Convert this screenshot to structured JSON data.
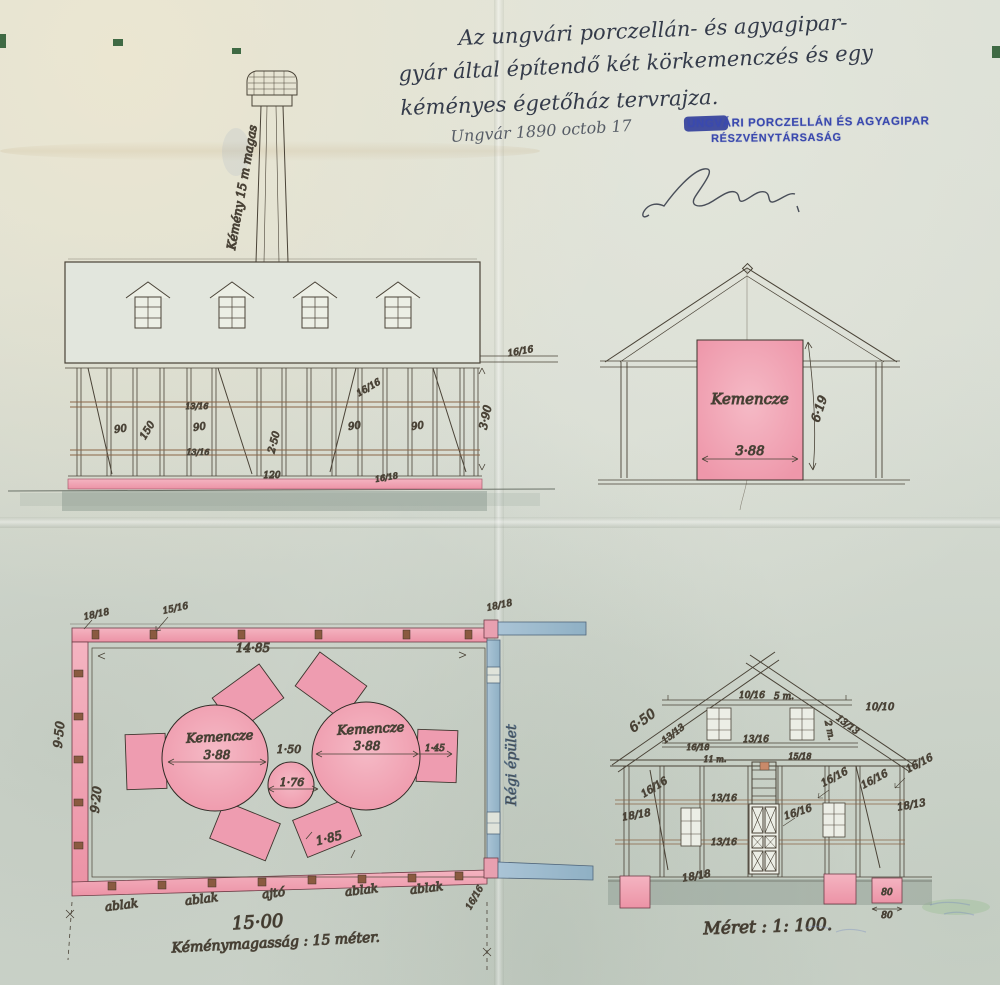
{
  "header": {
    "title_line1": "Az ungvári porczellán- és agyagipar-",
    "title_line2": "gyár által építendő két körkemenczés és egy",
    "title_line3": "kéményes égetőház tervrajza.",
    "date": "Ungvár 1890 octob 17",
    "stamp": {
      "line1": "UNGVÁRI PORCZELLÁN ÉS AGYAGIPAR",
      "line2": "RÉSZVÉNYTÁRSASÁG"
    }
  },
  "front_elevation": {
    "chimney_label": "Kémény 15 m magas",
    "dims": {
      "bay1": "90",
      "mid_height": "150",
      "bay2": "90",
      "timber_upper": "13/16",
      "timber_lower": "13/16",
      "wall_height": "2·50",
      "door_width": "120",
      "bay3": "90",
      "bay4": "90",
      "beam_inner": "16/16",
      "beam_right": "16/16",
      "right_height": "3·90",
      "sill": "16/18"
    }
  },
  "cross_section": {
    "kiln_label": "Kemencze",
    "kiln_width": "3·88",
    "kiln_height": "6·19"
  },
  "floor_plan": {
    "kiln1_label": "Kemencze",
    "kiln2_label": "Kemencze",
    "dims": {
      "inner_width": "14·85",
      "outer_depth": "9·50",
      "inner_depth": "9·20",
      "kiln1_diameter": "3·88",
      "kiln2_diameter": "3·88",
      "kiln_gap": "1·50",
      "flue_diameter": "1·76",
      "side_clearance": "1·45",
      "chamber_width": "1·85",
      "total_width": "15·00",
      "corner_tl": "18/18",
      "top_post": "15/16",
      "corner_tr": "18/18",
      "corner_br": "16/16"
    },
    "openings": [
      "ablak",
      "ablak",
      "ajtó",
      "ablak",
      "ablak"
    ],
    "old_building_label": "Régi épület",
    "note": "Kéménymagasság : 15 méter."
  },
  "gable_elevation": {
    "dims": {
      "roof_left": "6·50",
      "rafter_left": "13/13",
      "collar": "10/16",
      "collar_span": "5 m.",
      "purlin_right": "10/10",
      "rafter_right": "13/13",
      "strut_right": "2 m.",
      "tie_left": "16/18",
      "tie_center": "13/16",
      "plate_span": "11 m.",
      "plate_right": "15/18",
      "post_r1": "16/16",
      "post_r2": "16/16",
      "corner_post_right": "16/16",
      "brace_left": "16/16",
      "sill_left": "18/18",
      "rail_upper": "13/16",
      "rail_lower": "13/16",
      "door_post": "16/16",
      "corner_right": "18/13",
      "sill_bottom": "18/18"
    },
    "foundation_detail": {
      "block_label": "80",
      "width_dim": "80"
    },
    "scale_label": "Méret : 1: 100."
  }
}
